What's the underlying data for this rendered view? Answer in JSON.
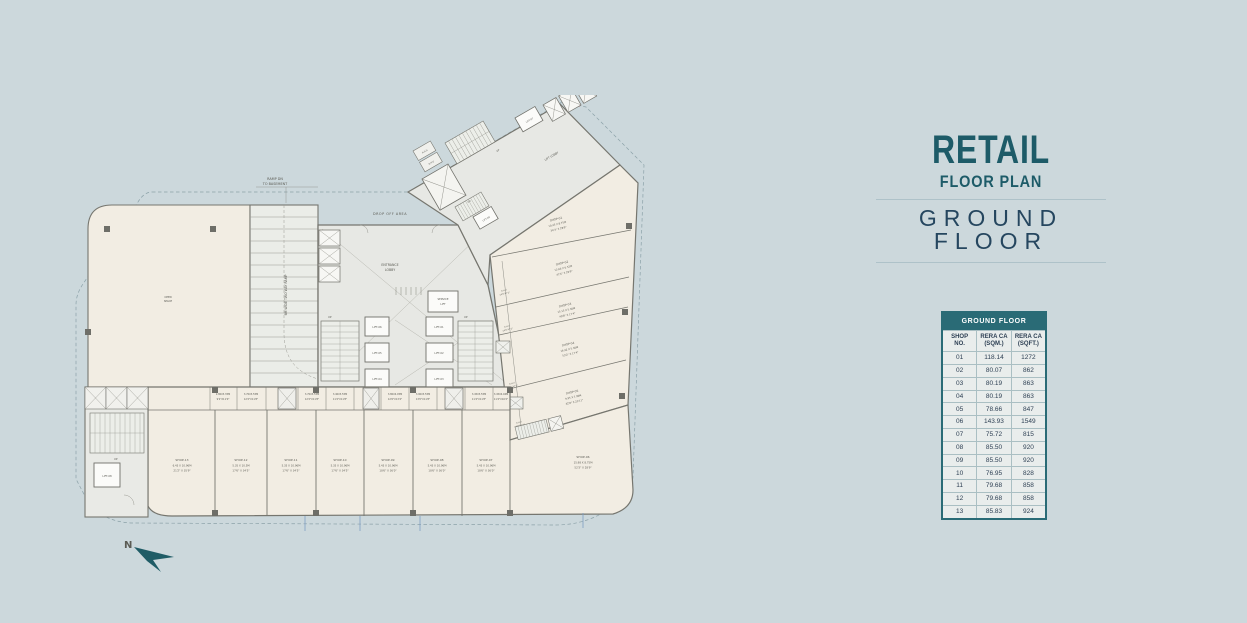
{
  "title_block": {
    "line1": "RETAIL",
    "line2": "FLOOR PLAN",
    "line3": "GROUND FLOOR",
    "accent_color": "#1d5b68",
    "navy_color": "#25465f"
  },
  "table": {
    "title": "GROUND FLOOR",
    "header_bg": "#2a6b76",
    "columns": [
      "SHOP\nNO.",
      "RERA CA\n(SQM.)",
      "RERA CA\n(SQFT.)"
    ],
    "rows": [
      [
        "01",
        "118.14",
        "1272"
      ],
      [
        "02",
        "80.07",
        "862"
      ],
      [
        "03",
        "80.19",
        "863"
      ],
      [
        "04",
        "80.19",
        "863"
      ],
      [
        "05",
        "78.66",
        "847"
      ],
      [
        "06",
        "143.93",
        "1549"
      ],
      [
        "07",
        "75.72",
        "815"
      ],
      [
        "08",
        "85.50",
        "920"
      ],
      [
        "09",
        "85.50",
        "920"
      ],
      [
        "10",
        "76.95",
        "828"
      ],
      [
        "11",
        "79.68",
        "858"
      ],
      [
        "12",
        "79.68",
        "858"
      ],
      [
        "13",
        "85.83",
        "924"
      ]
    ]
  },
  "plan": {
    "north_label": "N",
    "ramp_note_line1": "RAMP DN",
    "ramp_note_line2": "TO BASEMENT",
    "ramp_label": "6M WIDE TWO WAY RAMP",
    "drop_off": "DROP OFF AREA",
    "entrance_line1": "ENTRANCE",
    "entrance_line2": "LOBBY",
    "lift_lobby": "LIFT LOBBY",
    "service_line1": "SERVICE",
    "service_line2": "LIFT",
    "up": "UP",
    "dn": "DN",
    "ahu": "A.H.U",
    "ahu_dim": "14'0\"X7'2\"",
    "open_line1": "OPEN",
    "open_line2": "SPACE",
    "lifts": {
      "l01": "LIFT-01",
      "l02": "LIFT-02",
      "l03": "LIFT-03",
      "l04": "LIFT-04",
      "l05": "LIFT-05",
      "l06": "LIFT-06",
      "l07": "LIFT-07",
      "l08": "LIFT-08",
      "l09": "LIFT-09"
    },
    "shops": [
      {
        "name": "SHOP-01",
        "dim_m": "10.45 X 8.75M",
        "dim_ft": "34'3\" X 28'9\""
      },
      {
        "name": "SHOP-02",
        "dim_m": "12.66 X 6.32M",
        "dim_ft": "41'6\" X 20'9\""
      },
      {
        "name": "SHOP-03",
        "dim_m": "15.13 X 5.30M",
        "dim_ft": "49'8\" X 17'4\""
      },
      {
        "name": "SHOP-04",
        "dim_m": "16.22 X 5.30M",
        "dim_ft": "53'2\" X 17'4\""
      },
      {
        "name": "SHOP-05",
        "dim_m": "9.95 X 7.90M",
        "dim_ft": "32'8\" X 25'11\""
      },
      {
        "name": "SHOP-06",
        "dim_m": "15.98 X 8.75M",
        "dim_ft": "52'3\" X 28'9\""
      },
      {
        "name": "SHOP-07",
        "dim_m": "5.43 X 10.96M",
        "dim_ft": "18'6\" X 36'0\""
      },
      {
        "name": "SHOP-08",
        "dim_m": "5.43 X 10.96M",
        "dim_ft": "18'6\" X 36'0\""
      },
      {
        "name": "SHOP-09",
        "dim_m": "5.43 X 10.96M",
        "dim_ft": "18'6\" X 36'0\""
      },
      {
        "name": "SHOP-10",
        "dim_m": "5.35 X 10.96M",
        "dim_ft": "17'6\" X 34'5\""
      },
      {
        "name": "SHOP-11",
        "dim_m": "5.35 X 10.96M",
        "dim_ft": "17'6\" X 34'5\""
      },
      {
        "name": "SHOP-12",
        "dim_m": "5.35 X 10.5M",
        "dim_ft": "17'6\" X 34'5\""
      },
      {
        "name": "SHOP-13",
        "dim_m": "6.43 X 10.96M",
        "dim_ft": "21'2\" X 35'9\""
      }
    ],
    "room_dims": [
      {
        "m": "2.80X3.35M",
        "ft": "9'2\"X11'0\""
      },
      {
        "m": "3.70X3.55M",
        "ft": "12'2\"X11'8\""
      },
      {
        "m": "3.70X3.55M",
        "ft": "12'2\"X11'8\""
      },
      {
        "m": "3.40X3.55M",
        "ft": "11'2\"X11'8\""
      },
      {
        "m": "3.80X4.05M",
        "ft": "12'6\"X13'4\""
      },
      {
        "m": "3.90X3.55M",
        "ft": "13'0\"X11'8\""
      },
      {
        "m": "3.45X3.55M",
        "ft": "11'4\"X11'8\""
      },
      {
        "m": "3.45X4.94M",
        "ft": "11'4\"X16'2\""
      }
    ]
  }
}
